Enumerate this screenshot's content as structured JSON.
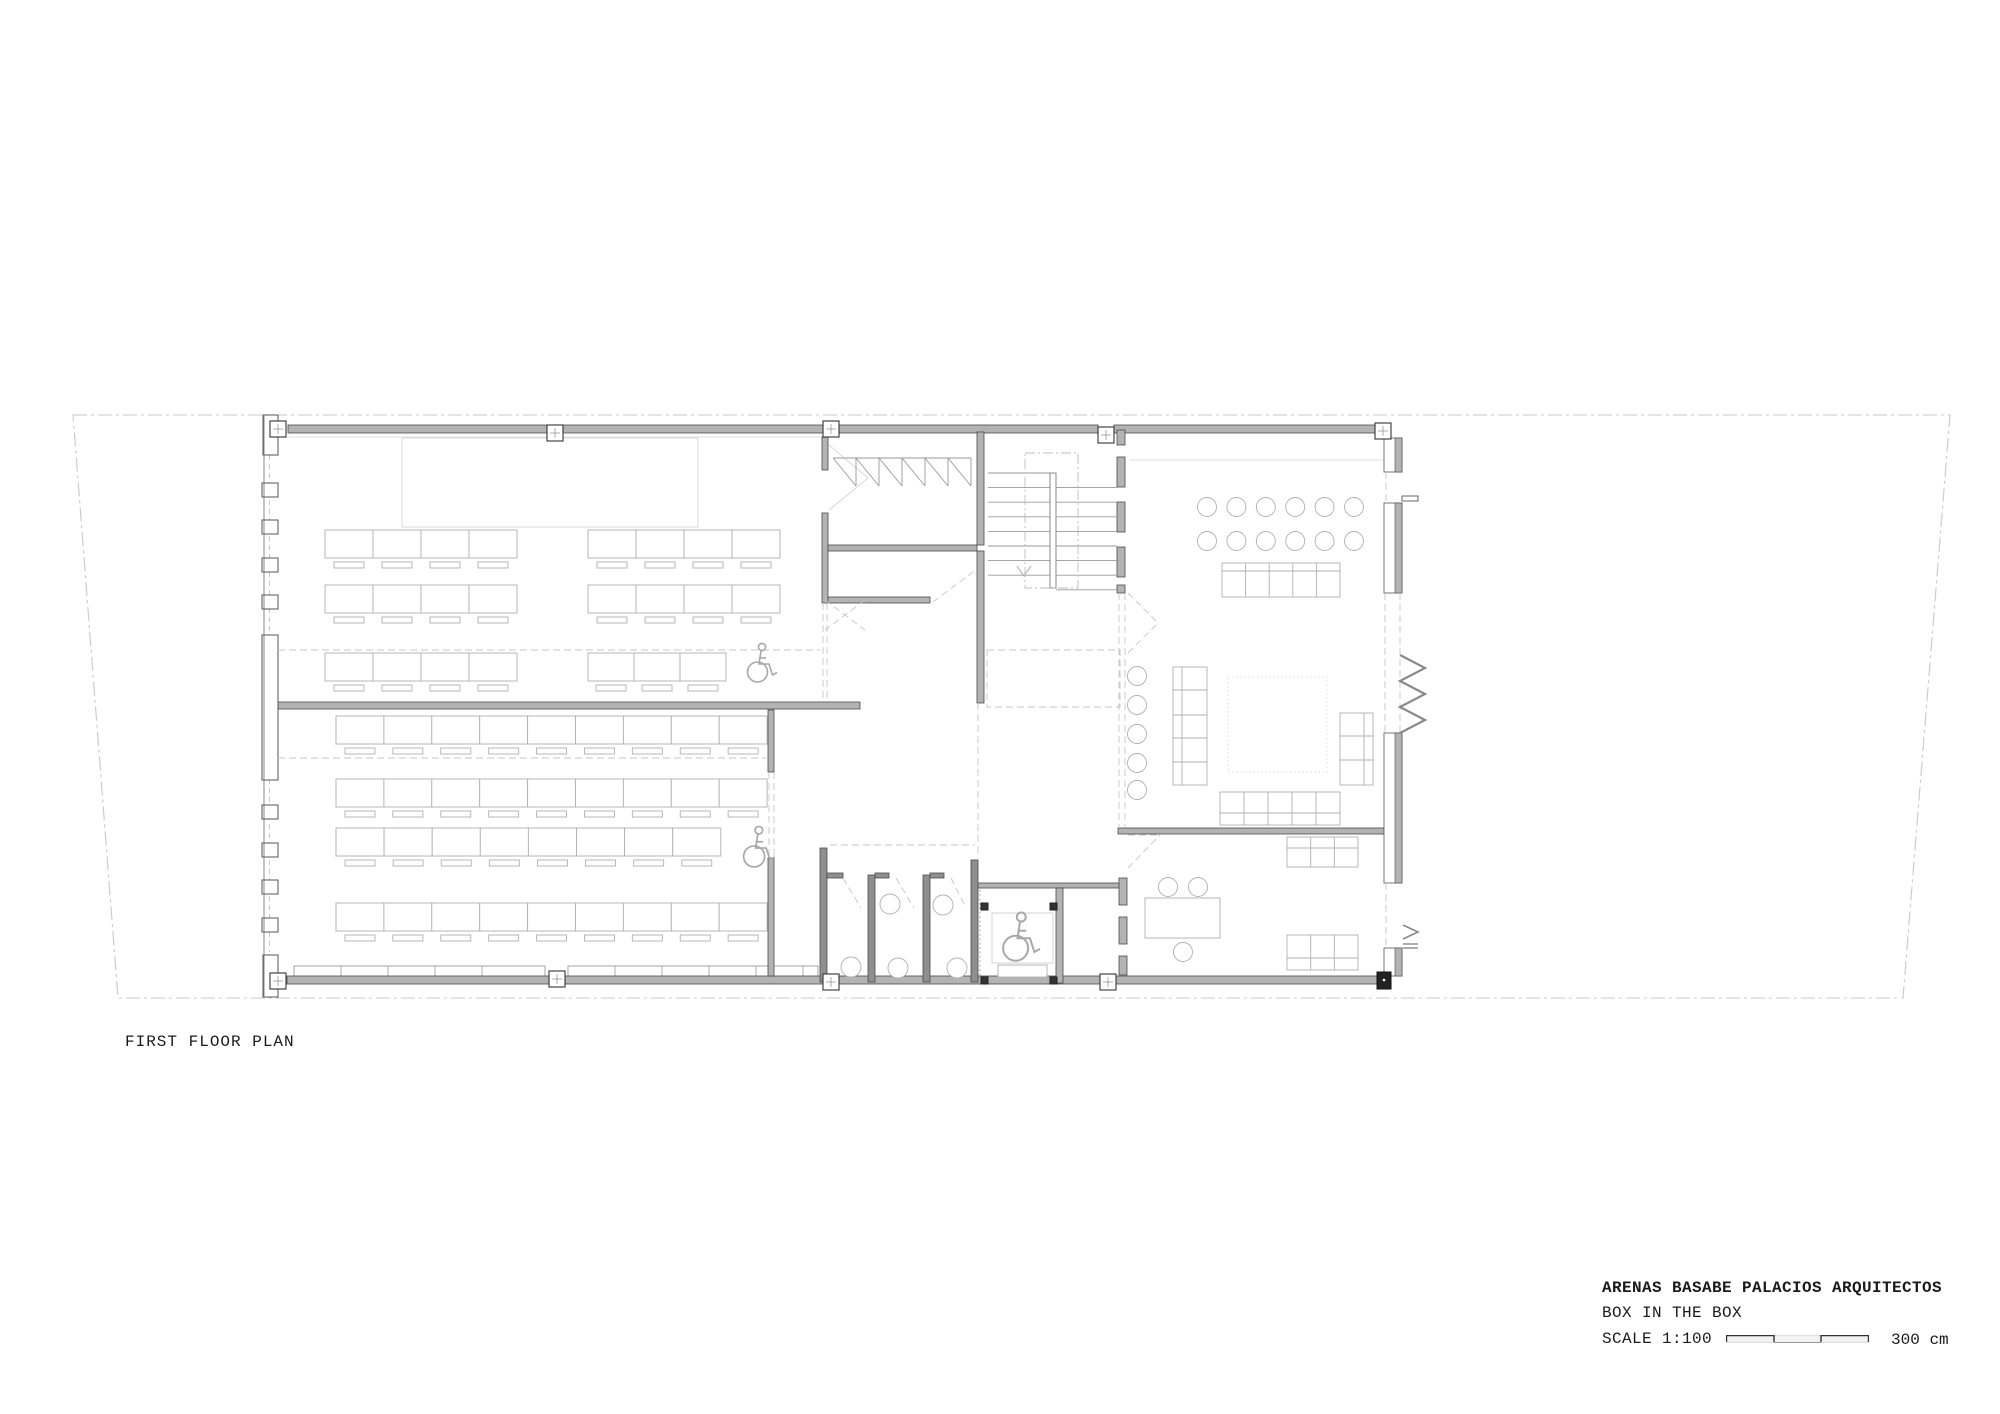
{
  "plan": {
    "label": "FIRST FLOOR PLAN"
  },
  "title_block": {
    "firm": "ARENAS BASABE PALACIOS ARQUITECTOS",
    "project": "BOX IN THE BOX",
    "scale": "SCALE 1:100",
    "scale_end": "300 cm"
  },
  "colors": {
    "ink": "#1a1a1a",
    "wall_fill": "#b3b3b3",
    "wall_edge": "#4a4a4a",
    "dark_wall": "#8f8f8f",
    "furniture": "#b0b0b0",
    "light_line": "#d8d8d8",
    "dashed": "#c6c6c6",
    "boundary": "#c9c9c9",
    "symbol": "#a8a8a8"
  }
}
